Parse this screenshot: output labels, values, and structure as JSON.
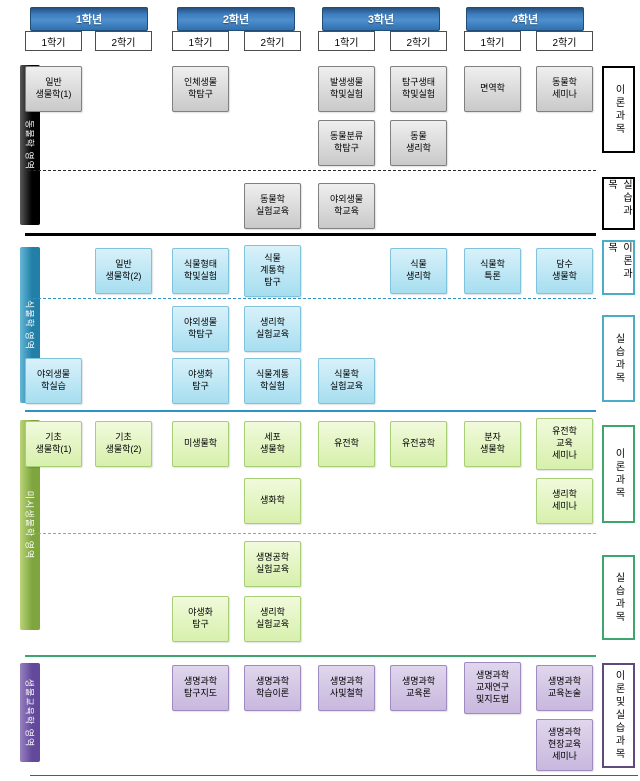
{
  "years": [
    {
      "label": "1학년",
      "semesters": [
        {
          "label": "1학기"
        },
        {
          "label": "2학기"
        }
      ]
    },
    {
      "label": "2학년",
      "semesters": [
        {
          "label": "1학기"
        },
        {
          "label": "2학기"
        }
      ]
    },
    {
      "label": "3학년",
      "semesters": [
        {
          "label": "1학기"
        },
        {
          "label": "2학기"
        }
      ]
    },
    {
      "label": "4학년",
      "semesters": [
        {
          "label": "1학기"
        },
        {
          "label": "2학기"
        }
      ]
    }
  ],
  "sections": [
    {
      "name": "animal-biology",
      "bar_label": "동물학 영역",
      "accent_color": "#000000",
      "right_labels": [
        {
          "label": "이론과목"
        },
        {
          "label": "실습과목"
        }
      ],
      "courses": [
        {
          "label": "일반\n생물학(1)",
          "year": 1,
          "semester": 1,
          "row": 1
        },
        {
          "label": "인체생물\n학탐구",
          "year": 2,
          "semester": 1,
          "row": 1
        },
        {
          "label": "발생생물\n학및실험",
          "year": 3,
          "semester": 1,
          "row": 1
        },
        {
          "label": "탐구생태\n학및실험",
          "year": 3,
          "semester": 2,
          "row": 1
        },
        {
          "label": "면역학",
          "year": 4,
          "semester": 1,
          "row": 1
        },
        {
          "label": "동물학\n세미나",
          "year": 4,
          "semester": 2,
          "row": 1
        },
        {
          "label": "동물분류\n학탐구",
          "year": 3,
          "semester": 1,
          "row": 2
        },
        {
          "label": "동물\n생리학",
          "year": 3,
          "semester": 2,
          "row": 2
        },
        {
          "label": "동물학\n실험교육",
          "year": 2,
          "semester": 2,
          "row": 3
        },
        {
          "label": "야외생물\n학교육",
          "year": 3,
          "semester": 1,
          "row": 3
        }
      ]
    },
    {
      "name": "plant-biology",
      "bar_label": "식물학 영역",
      "accent_color": "#2E93C4",
      "right_labels": [
        {
          "label": "이론과목"
        },
        {
          "label": "실습과목"
        }
      ],
      "courses": [
        {
          "label": "일반\n생물학(2)",
          "year": 1,
          "semester": 2,
          "row": 1
        },
        {
          "label": "식물형태\n학및실험",
          "year": 2,
          "semester": 1,
          "row": 1
        },
        {
          "label": "식물\n계통학\n탐구",
          "year": 2,
          "semester": 2,
          "row": 1
        },
        {
          "label": "식물\n생리학",
          "year": 3,
          "semester": 2,
          "row": 1
        },
        {
          "label": "식물학\n특론",
          "year": 4,
          "semester": 1,
          "row": 1
        },
        {
          "label": "담수\n생물학",
          "year": 4,
          "semester": 2,
          "row": 1
        },
        {
          "label": "야외생물\n학탐구",
          "year": 2,
          "semester": 1,
          "row": 2
        },
        {
          "label": "생리학\n실험교육",
          "year": 2,
          "semester": 2,
          "row": 2
        },
        {
          "label": "야외생물\n학실습",
          "year": 1,
          "semester": 1,
          "row": 3
        },
        {
          "label": "야생화\n탐구",
          "year": 2,
          "semester": 1,
          "row": 3
        },
        {
          "label": "식물계통\n학실험",
          "year": 2,
          "semester": 2,
          "row": 3
        },
        {
          "label": "식물학\n실험교육",
          "year": 3,
          "semester": 1,
          "row": 3
        }
      ]
    },
    {
      "name": "micro-biology",
      "bar_label": "미시생물학 영역",
      "accent_color": "#3FA46D",
      "right_labels": [
        {
          "label": "이론과목"
        },
        {
          "label": "실습과목"
        }
      ],
      "courses": [
        {
          "label": "기초\n생물학(1)",
          "year": 1,
          "semester": 1,
          "row": 1
        },
        {
          "label": "기초\n생물학(2)",
          "year": 1,
          "semester": 2,
          "row": 1
        },
        {
          "label": "미생물학",
          "year": 2,
          "semester": 1,
          "row": 1
        },
        {
          "label": "세포\n생물학",
          "year": 2,
          "semester": 2,
          "row": 1
        },
        {
          "label": "유전학",
          "year": 3,
          "semester": 1,
          "row": 1
        },
        {
          "label": "유전공학",
          "year": 3,
          "semester": 2,
          "row": 1
        },
        {
          "label": "분자\n생물학",
          "year": 4,
          "semester": 1,
          "row": 1
        },
        {
          "label": "유전학\n교육\n세미나",
          "year": 4,
          "semester": 2,
          "row": 1
        },
        {
          "label": "생화학",
          "year": 2,
          "semester": 2,
          "row": 2
        },
        {
          "label": "생리학\n세미나",
          "year": 4,
          "semester": 2,
          "row": 2
        },
        {
          "label": "생명공학\n실험교육",
          "year": 2,
          "semester": 2,
          "row": 3
        },
        {
          "label": "야생화\n탐구",
          "year": 2,
          "semester": 1,
          "row": 4
        },
        {
          "label": "생리학\n실험교육",
          "year": 2,
          "semester": 2,
          "row": 4
        }
      ]
    },
    {
      "name": "biology-education",
      "bar_label": "생물교육학 영역",
      "accent_color": "#604A7B",
      "right_labels": [
        {
          "label": "이론및실습과목"
        }
      ],
      "courses": [
        {
          "label": "생명과학\n탐구지도",
          "year": 2,
          "semester": 1,
          "row": 1
        },
        {
          "label": "생명과학\n학습이론",
          "year": 2,
          "semester": 2,
          "row": 1
        },
        {
          "label": "생명과학\n사및철학",
          "year": 3,
          "semester": 1,
          "row": 1
        },
        {
          "label": "생명과학\n교육론",
          "year": 3,
          "semester": 2,
          "row": 1
        },
        {
          "label": "생명과학\n교재연구\n및지도법",
          "year": 4,
          "semester": 1,
          "row": 1
        },
        {
          "label": "생명과학\n교육논술",
          "year": 4,
          "semester": 2,
          "row": 1
        },
        {
          "label": "생명과학\n현장교육\n세미나",
          "year": 4,
          "semester": 2,
          "row": 2
        }
      ]
    }
  ]
}
